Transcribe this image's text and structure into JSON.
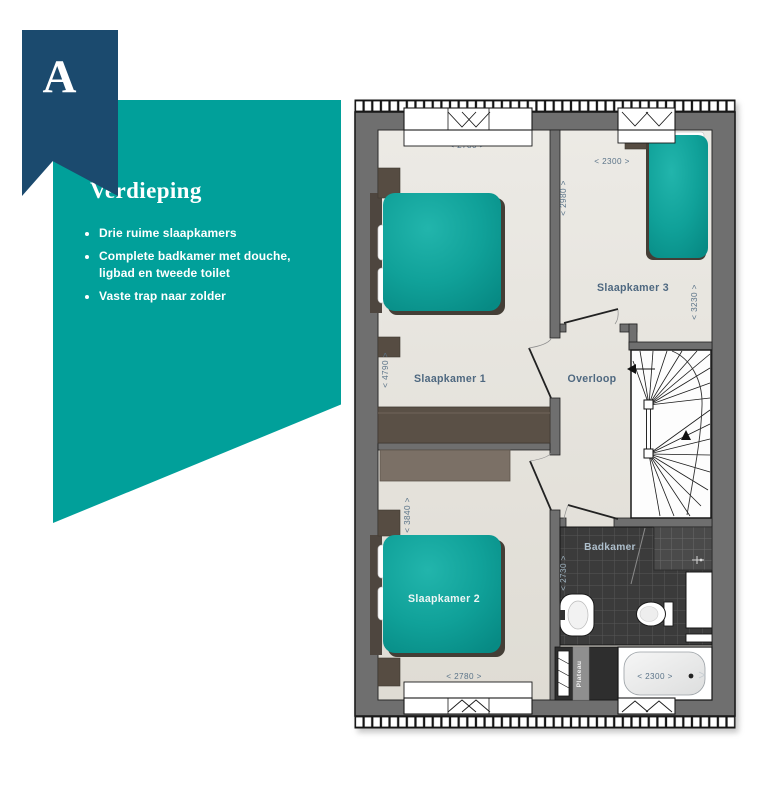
{
  "badge": {
    "letter": "A"
  },
  "info_card": {
    "title": "Verdieping",
    "bullets": [
      "Drie ruime slaapkamers",
      "Complete badkamer met douche, ligbad en tweede toilet",
      "Vaste trap naar zolder"
    ]
  },
  "floorplan": {
    "rooms": {
      "slaapkamer1": {
        "label": "Slaapkamer 1",
        "width_dim": "< 2780 >",
        "depth_dim": "< 4790 >"
      },
      "slaapkamer2": {
        "label": "Slaapkamer 2",
        "width_dim": "< 2780 >",
        "depth_dim": "< 3840 >"
      },
      "slaapkamer3": {
        "label": "Slaapkamer 3",
        "width_dim": "< 2300 >",
        "depth_dim": "< 2980 >",
        "side_dim": "< 3230 >"
      },
      "overloop": {
        "label": "Overloop"
      },
      "badkamer": {
        "label": "Badkamer",
        "depth_dim": "< 2730 >",
        "bath_dim": "< 2300 >"
      },
      "plateau": {
        "label": "Plateau"
      }
    },
    "colors": {
      "accent_teal": "#01A09A",
      "navy": "#1B4A6E",
      "bed_teal": "#0FA69D",
      "wall_gray": "#6F6F6F",
      "tile_dark": "#3B3B3B"
    }
  }
}
